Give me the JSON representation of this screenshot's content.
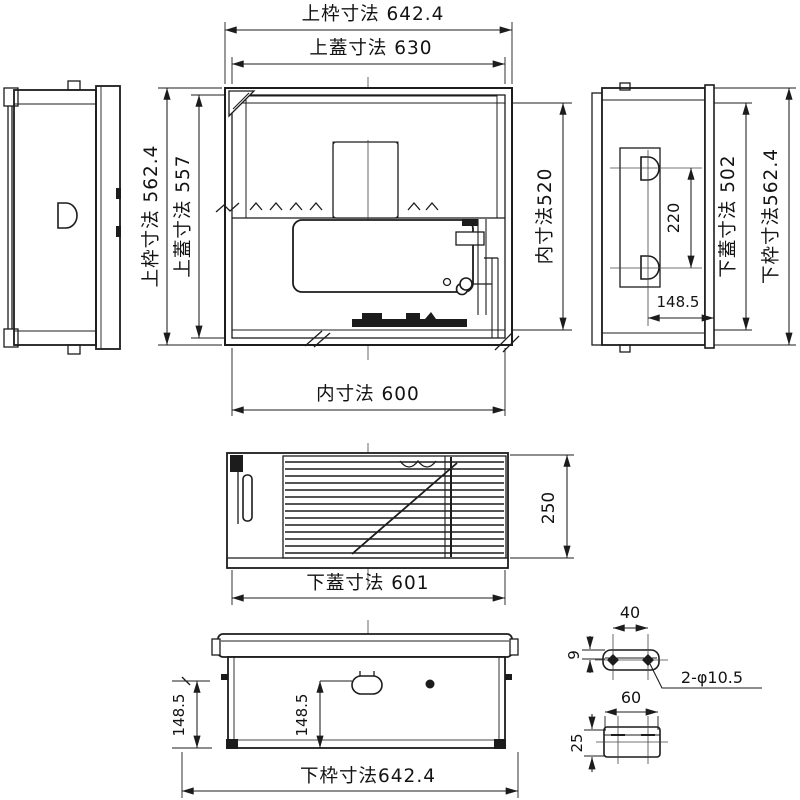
{
  "canvas": {
    "background": "#ffffff",
    "ink": "#1c1c1c"
  },
  "drawing_type": "technical-dimension-drawing",
  "dimensions": {
    "top_frame_width": "上枠寸法 642.4",
    "top_lid_width": "上蓋寸法 630",
    "left_frame_height": "上枠寸法 562.4",
    "left_lid_height": "上蓋寸法 557",
    "inner_height": "内寸法520",
    "inner_width": "内寸法 600",
    "side_hole_pitch": "220",
    "side_hole_offset": "148.5",
    "side_lid_height": "下蓋寸法 502",
    "side_frame_height": "下枠寸法562.4",
    "front_height": "250",
    "front_lid_width": "下蓋寸法 601",
    "bottom_offset_outer": "148.5",
    "bottom_offset_center": "148.5",
    "bottom_frame_width": "下枠寸法642.4",
    "detail_hole_pitch": "40",
    "detail_flange_offset": "9",
    "detail_hole_note": "2-φ10.5",
    "detail_width": "60",
    "detail_height": "25"
  }
}
